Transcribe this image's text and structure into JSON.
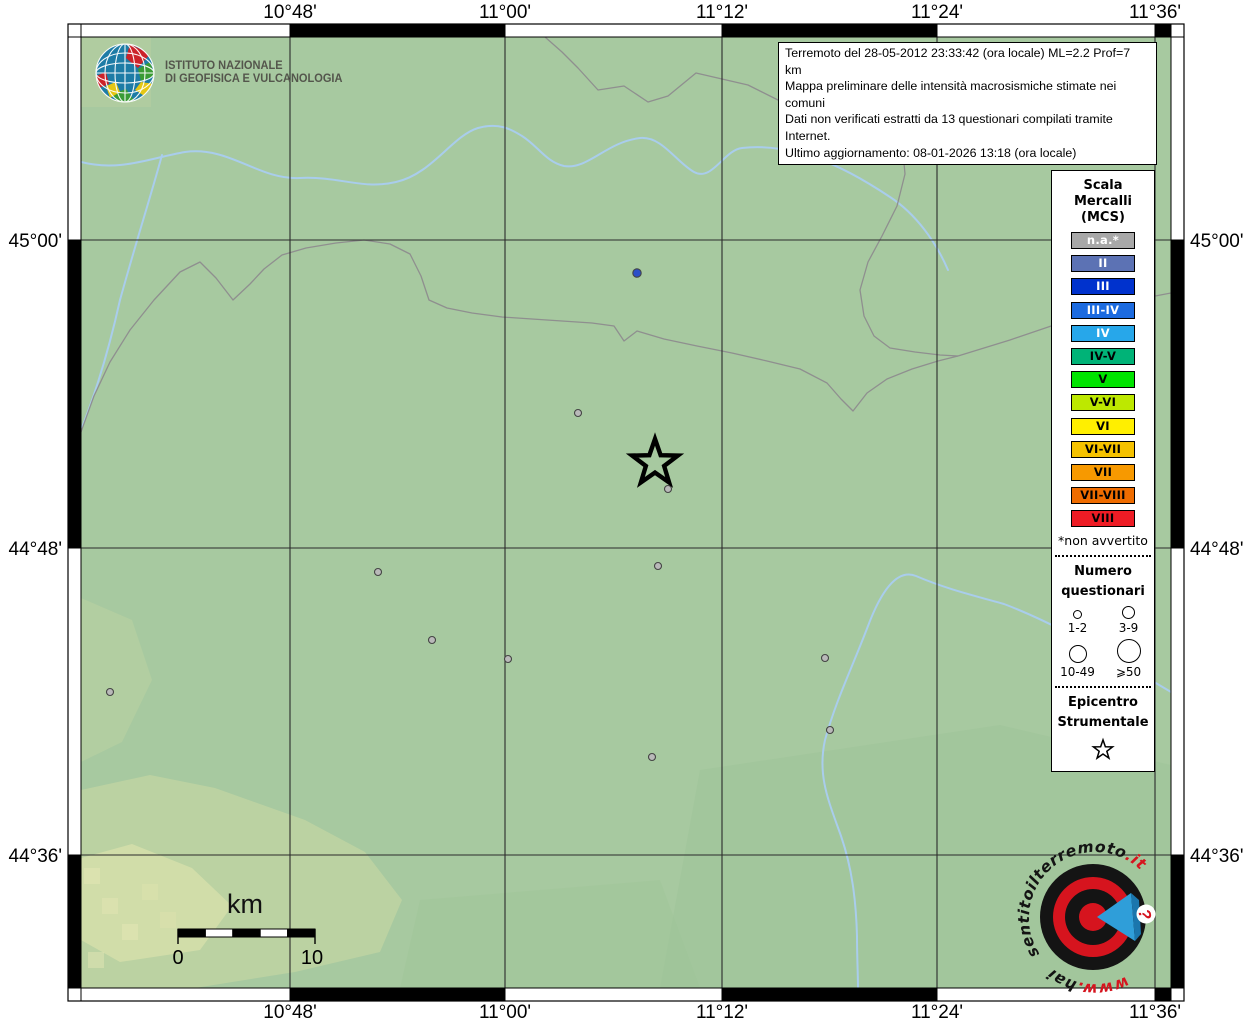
{
  "info_box": {
    "lines": [
      "Terremoto del 28-05-2012 23:33:42 (ora locale) ML=2.2 Prof=7 km",
      "Mappa preliminare delle intensità macrosismiche stimate nei comuni",
      "Dati non verificati estratti da 13 questionari compilati tramite Internet.",
      "Ultimo aggiornamento: 08-01-2026 13:18 (ora locale)"
    ]
  },
  "axis": {
    "top": [
      "10°48'",
      "11°00'",
      "11°12'",
      "11°24'",
      "11°36'"
    ],
    "bottom": [
      "10°48'",
      "11°00'",
      "11°12'",
      "11°24'",
      "11°36'"
    ],
    "left": [
      "45°00'",
      "44°48'",
      "44°36'"
    ],
    "right": [
      "45°00'",
      "44°48'",
      "44°36'"
    ]
  },
  "ingv_logo": {
    "line1": "ISTITUTO NAZIONALE",
    "line2": "DI GEOFISICA E VULCANOLOGIA"
  },
  "scale_bar": {
    "unit": "km",
    "start_label": "0",
    "end_label": "10"
  },
  "legend": {
    "title_lines": [
      "Scala",
      "Mercalli",
      "(MCS)"
    ],
    "classes": [
      {
        "label": "n.a.*",
        "bg": "#a8a8a8",
        "fg": "#ffffff"
      },
      {
        "label": "II",
        "bg": "#5c72b4",
        "fg": "#ffffff"
      },
      {
        "label": "III",
        "bg": "#0032cd",
        "fg": "#ffffff"
      },
      {
        "label": "III-IV",
        "bg": "#1c6be0",
        "fg": "#ffffff"
      },
      {
        "label": "IV",
        "bg": "#27a7ea",
        "fg": "#ffffff"
      },
      {
        "label": "IV-V",
        "bg": "#00b377",
        "fg": "#000000"
      },
      {
        "label": "V",
        "bg": "#00e400",
        "fg": "#000000"
      },
      {
        "label": "V-VI",
        "bg": "#bde800",
        "fg": "#000000"
      },
      {
        "label": "VI",
        "bg": "#ffef00",
        "fg": "#000000"
      },
      {
        "label": "VI-VII",
        "bg": "#f5c200",
        "fg": "#000000"
      },
      {
        "label": "VII",
        "bg": "#f79900",
        "fg": "#000000"
      },
      {
        "label": "VII-VIII",
        "bg": "#ef6c00",
        "fg": "#000000"
      },
      {
        "label": "VIII",
        "bg": "#ee1c25",
        "fg": "#000000"
      }
    ],
    "footnote": "*non avvertito",
    "questionnaires": {
      "title_lines": [
        "Numero",
        "questionari"
      ],
      "items": [
        {
          "label": "1-2",
          "d": 7
        },
        {
          "label": "3-9",
          "d": 11
        },
        {
          "label": "10-49",
          "d": 16
        },
        {
          "label": "⩾50",
          "d": 22
        }
      ]
    },
    "epicenter_title_lines": [
      "Epicentro",
      "Strumentale"
    ]
  },
  "watermark": {
    "www": "www.",
    "hai": "hai",
    "name": "sentitoilterremoto",
    "it": ".it",
    "qmark": "?"
  },
  "map_points": {
    "epicenter": {
      "x": 655,
      "y": 463
    },
    "dot_colors": {
      "na": "#b9b9b9",
      "II": "#2b4fc8"
    },
    "dots": [
      {
        "x": 637,
        "y": 273,
        "k": "II"
      },
      {
        "x": 578,
        "y": 413,
        "k": "na"
      },
      {
        "x": 668,
        "y": 489,
        "k": "na"
      },
      {
        "x": 658,
        "y": 566,
        "k": "na"
      },
      {
        "x": 378,
        "y": 572,
        "k": "na"
      },
      {
        "x": 432,
        "y": 640,
        "k": "na"
      },
      {
        "x": 508,
        "y": 659,
        "k": "na"
      },
      {
        "x": 825,
        "y": 658,
        "k": "na"
      },
      {
        "x": 110,
        "y": 692,
        "k": "na"
      },
      {
        "x": 830,
        "y": 730,
        "k": "na"
      },
      {
        "x": 652,
        "y": 757,
        "k": "na"
      }
    ]
  },
  "map_colors": {
    "land": "#a7c9a0",
    "terrain_pale": "#d5dfab",
    "river": "#a9cdec",
    "boundary": "#8f8f8f",
    "grid": "#2b2b2b",
    "watermark_red": "#d6141e",
    "watermark_blue": "#2f9ed9"
  }
}
